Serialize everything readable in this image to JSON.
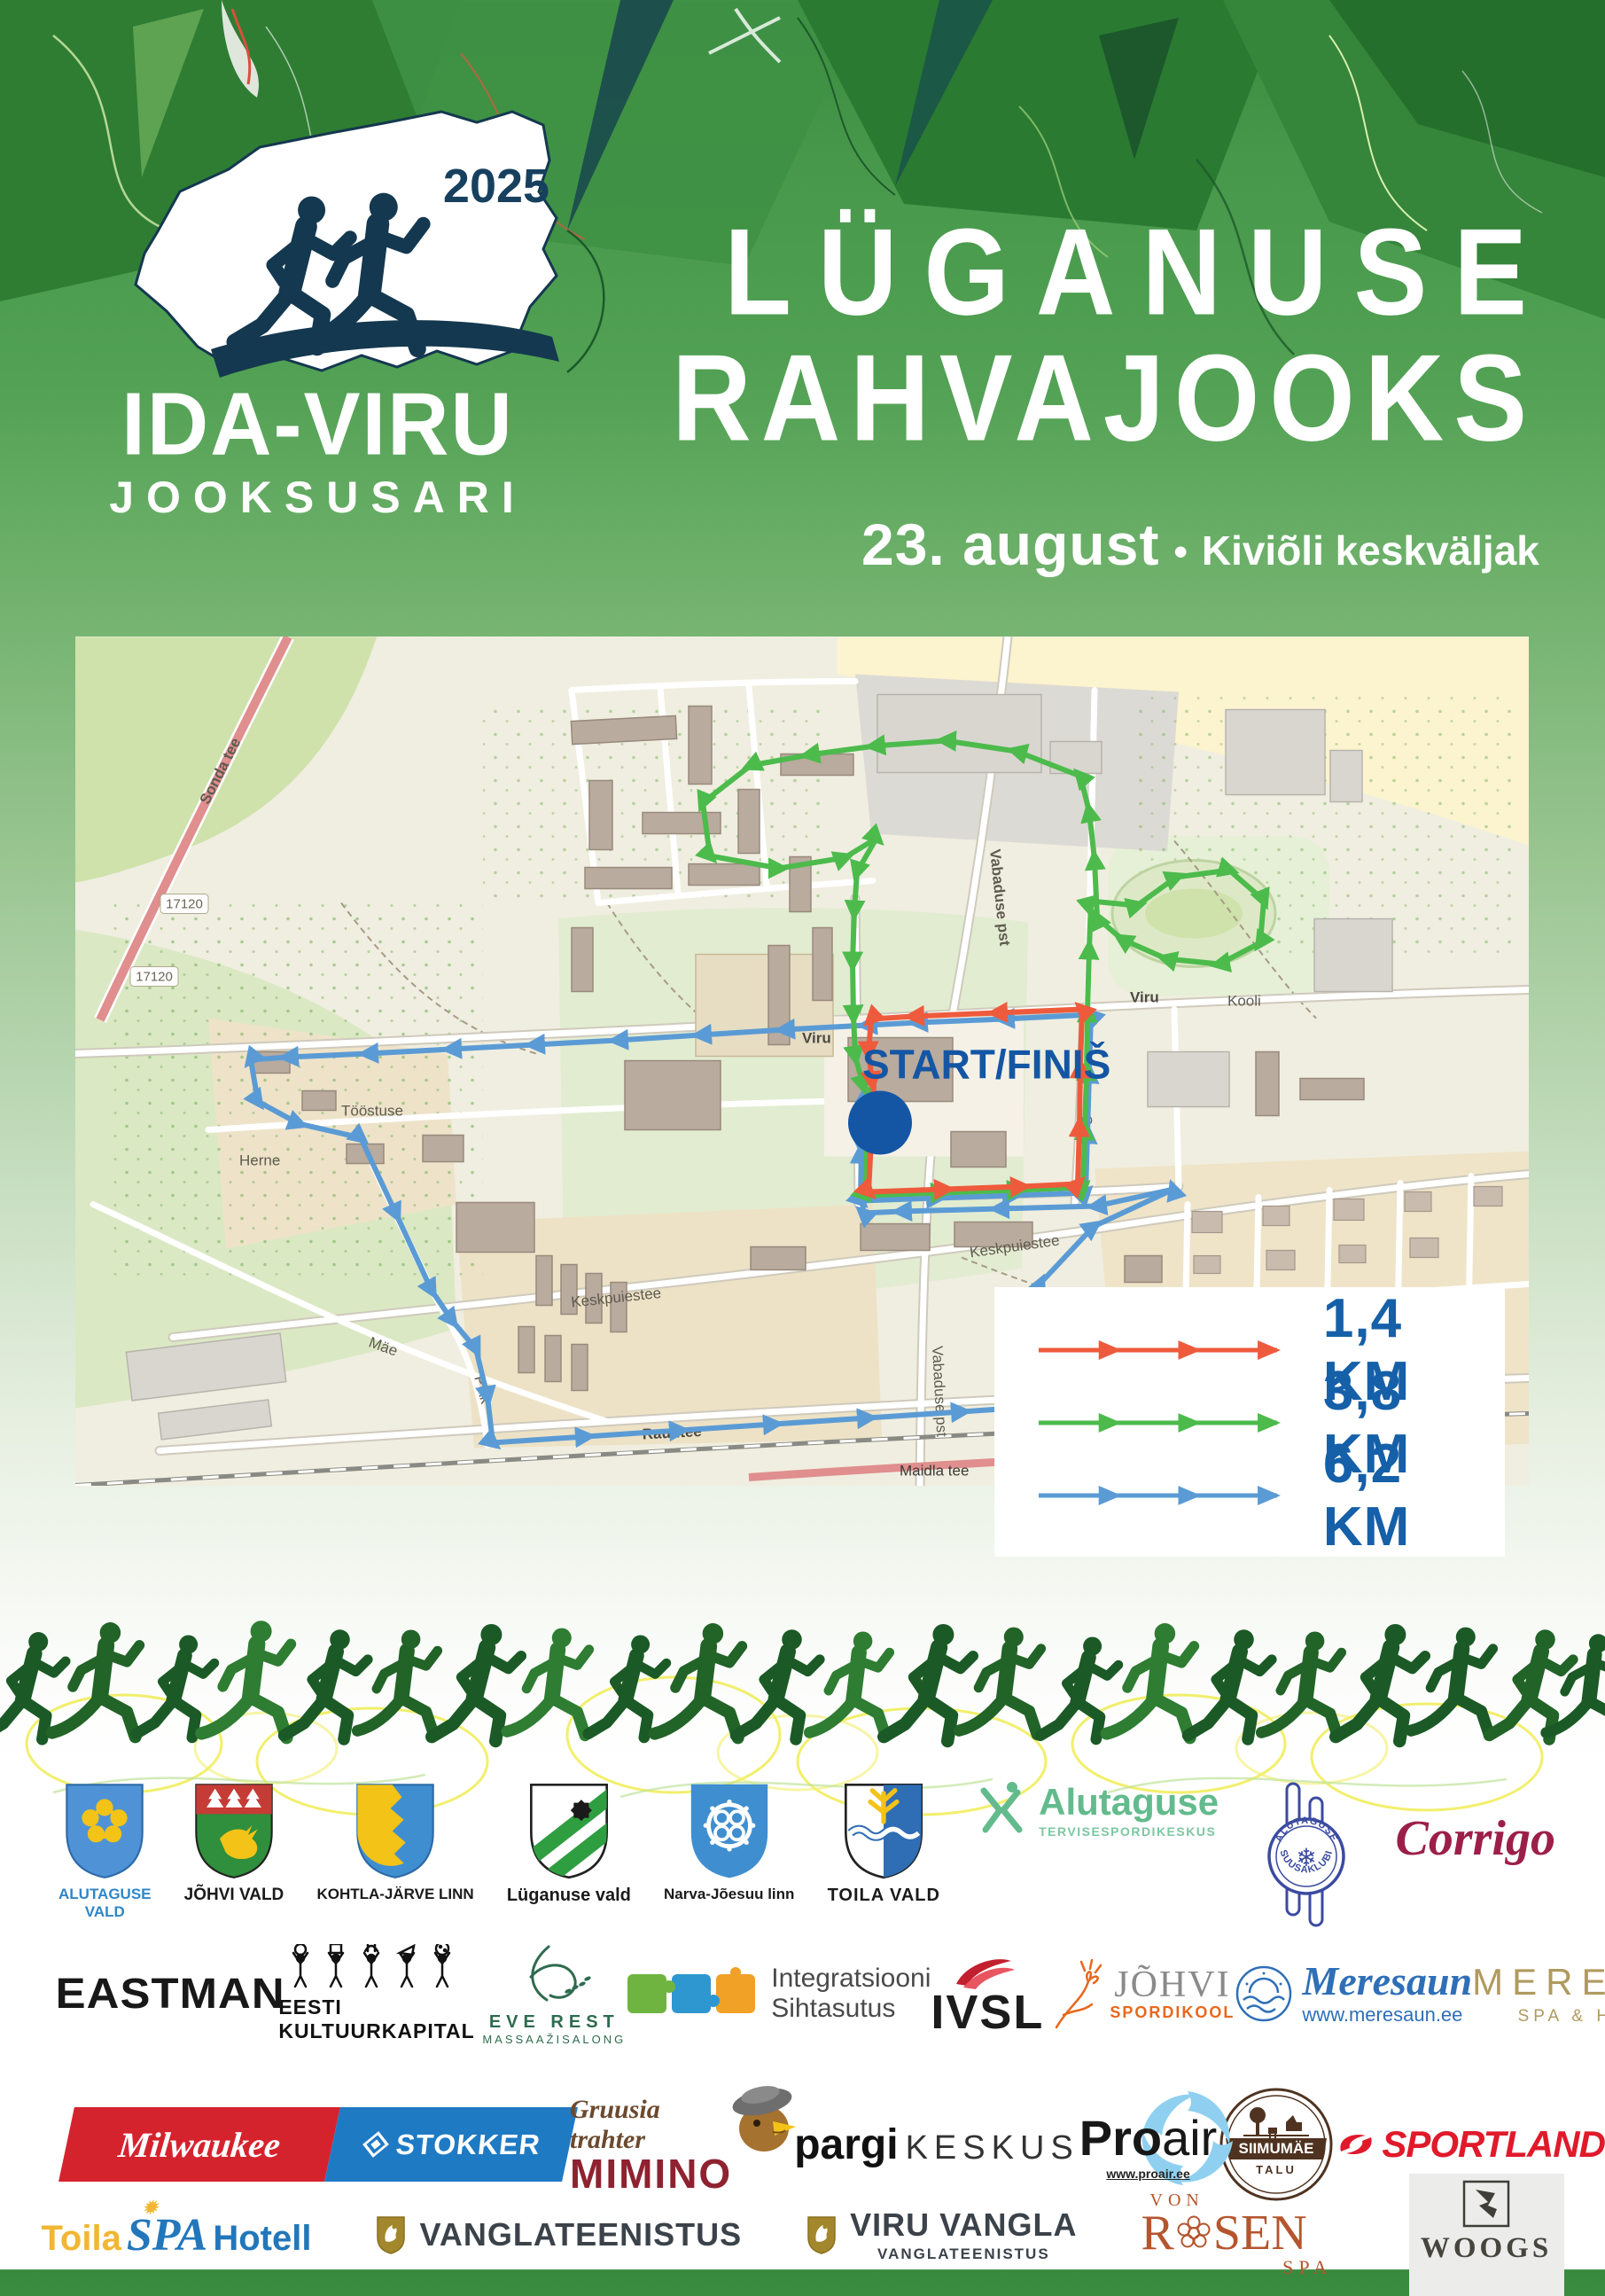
{
  "poster": {
    "year": "2025",
    "series": {
      "line1": "IDA-VIRU",
      "line2": "JOOKSUSARI"
    },
    "title": {
      "line1": "LÜGANUSE",
      "line2": "RAHVAJOOKS"
    },
    "date": "23. august",
    "separator": "•",
    "venue": "Kiviõli keskväljak"
  },
  "map": {
    "start_finish": "START/FINIŠ",
    "road_ref": "17120",
    "streets": [
      "Sonda tee",
      "Vabaduse pst",
      "Vabaduse pst",
      "Keskpuiestee",
      "Keskpuiestee",
      "Viru",
      "Viru",
      "Raudtee",
      "Raudtee",
      "Maidla tee",
      "Lepa tee",
      "Soo",
      "Kooli",
      "Pikk",
      "Herne",
      "Mäe",
      "Tööstuse"
    ],
    "legend": [
      {
        "label": "1,4 KM",
        "color": "#ee5b3c"
      },
      {
        "label": "3,8 KM",
        "color": "#4cbb4c"
      },
      {
        "label": "6,2 KM",
        "color": "#5b9bd5"
      }
    ],
    "colors": {
      "route_red": "#ee5b3c",
      "route_green": "#4cbb4c",
      "route_blue": "#5b9bd5",
      "legend_text": "#1560a8",
      "start_text": "#1456a4"
    }
  },
  "sponsors": {
    "row1": [
      {
        "caption1": "ALUTAGUSE",
        "caption2": "VALD"
      },
      {
        "caption": "JÕHVI VALD"
      },
      {
        "caption": "KOHTLA-JÄRVE LINN"
      },
      {
        "caption": "Lüganuse vald"
      },
      {
        "caption": "Narva-Jõesuu linn"
      },
      {
        "caption": "TOILA VALD"
      },
      {
        "name": "Alutaguse",
        "sub": "TERVISESPORDIKESKUS"
      },
      {
        "arc_top": "ALUTAGUSE",
        "arc_bottom": "SUUSAKLUBI",
        "snowflake": "❄"
      },
      {
        "name": "Corrigo"
      }
    ],
    "row2": [
      {
        "name": "EASTMAN"
      },
      {
        "name": "EESTI KULTUURKAPITAL"
      },
      {
        "line1": "EVE REST",
        "line2": "MASSAAŽISALONG"
      },
      {
        "line1": "Integratsiooni",
        "line2": "Sihtasutus"
      },
      {
        "name": "IVSL"
      },
      {
        "line1": "JÕHVI",
        "line2": "SPORDIKOOL"
      },
      {
        "name": "Meresaun",
        "url": "www.meresaun.ee"
      },
      {
        "name": "MERESUU",
        "sub": "SPA & HOTEL"
      }
    ],
    "row3": [
      {
        "left": "Milwaukee",
        "right": "STOKKER"
      },
      {
        "script": "Gruusia trahter",
        "name": "MIMINO"
      },
      {
        "bold": "pargi",
        "light": "KESKUS"
      },
      {
        "pro": "Pro",
        "air": "air",
        "url": "www.proair.ee"
      },
      {
        "name": "SIIMUMÄE",
        "sub": "TALU"
      },
      {
        "name": "SPORTLAND"
      },
      {
        "name": "PEPSI"
      }
    ],
    "row4": [
      {
        "part1": "Toila",
        "part2": "SPA",
        "part3": "Hotell"
      },
      {
        "name": "VANGLATEENISTUS"
      },
      {
        "name": "VIRU VANGLA",
        "sub": "VANGLATEENISTUS"
      },
      {
        "top": "VON",
        "r": "R",
        "sen": "SEN",
        "bottom": "SPA"
      },
      {
        "name": "WOOGS"
      }
    ]
  }
}
